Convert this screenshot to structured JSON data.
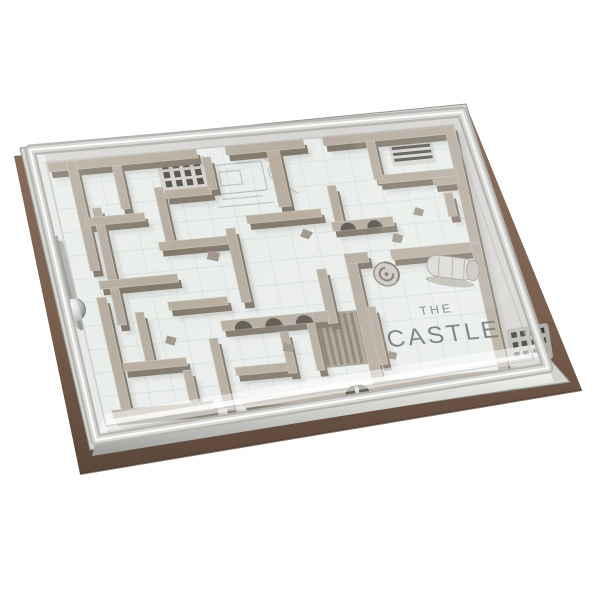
{
  "product": {
    "title_line1": "THE",
    "title_line2": "CASTLE",
    "description": "3D render of 'The Castle' ball-in-maze puzzle: a castle floor-plan maze tray with a steel ball and launch channel, covered by a clear plastic lid, mounted on a brown base, photographed at an angle on a white background."
  },
  "colors": {
    "background": "#ffffff",
    "base_brown": "#7b6052",
    "base_brown_dark": "#59453a",
    "tray_silver": "#d7d7d3",
    "lid_edge": "#d9d9d6",
    "wall_top": "#b4aa9d",
    "wall_side": "#7d7467",
    "wall_shadow": "#67625a",
    "floor": "#e9edea",
    "tile_line": "#c9d4d2",
    "engraving": "#5f6a63",
    "vent_dark": "#3b3933",
    "ball_metal": "#8f8f8f"
  },
  "visible_features": [
    "steel-ball",
    "ball-launch-channel",
    "staircase-ramp",
    "arched-walls",
    "spiral-staircase",
    "barrel",
    "porthole-cross-window",
    "floor-grille-vent",
    "slat-vent",
    "side-ventilation-slots",
    "engraved-floor-sketch",
    "ruined-castle-walls",
    "clear-lid",
    "brown-base"
  ]
}
